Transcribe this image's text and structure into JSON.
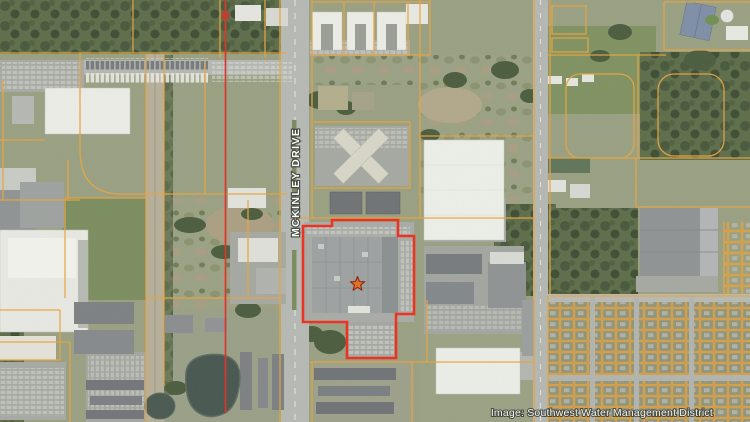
{
  "map": {
    "street_label": "MCKINLEY DRIVE",
    "attribution": "Image: Southwest Water Management District",
    "highlight": {
      "points": "303,226 332,226 332,220 398,220 398,236 414,236 414,314 396,314 396,358 347,358 347,322 303,322",
      "color": "#f02c1c"
    },
    "section_line": {
      "color": "#dc3126"
    },
    "parcel_lines": {
      "color": "#e9a43e"
    },
    "star_marker": {
      "fill": "#e0711f",
      "stroke": "#8f1b0c"
    }
  }
}
